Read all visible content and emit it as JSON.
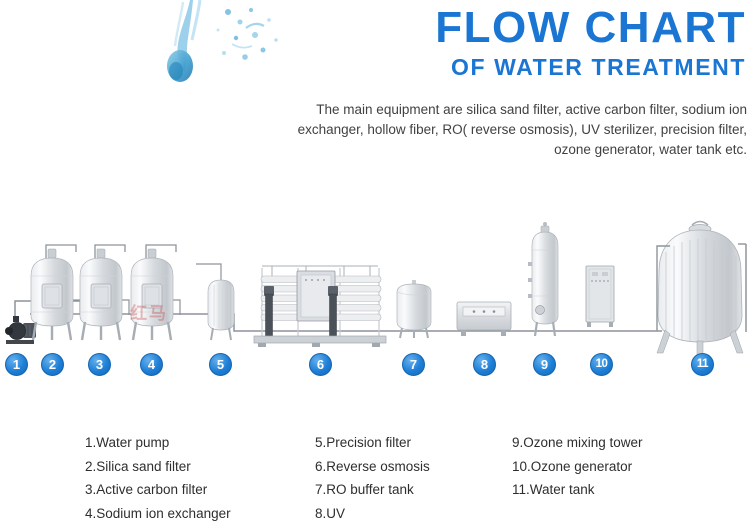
{
  "header": {
    "title": "FLOW CHART",
    "subtitle": "OF WATER TREATMENT"
  },
  "description": "The main equipment are silica sand filter, active carbon filter, sodium ion exchanger, hollow fiber, RO( reverse osmosis), UV sterilizer, precision filter, ozone generator, water tank etc.",
  "watermark": "红马",
  "colors": {
    "accent_blue": "#1a76d2",
    "badge_blue": "#1e7fd6",
    "body_text": "#414141"
  },
  "diagram": {
    "badges": [
      {
        "n": "1",
        "x": 17,
        "label": "Water pump"
      },
      {
        "n": "2",
        "x": 53,
        "label": "Silica sand filter"
      },
      {
        "n": "3",
        "x": 100,
        "label": "Active carbon filter"
      },
      {
        "n": "4",
        "x": 152,
        "label": "Sodium ion exchanger"
      },
      {
        "n": "5",
        "x": 221,
        "label": "Precision filter"
      },
      {
        "n": "6",
        "x": 321,
        "label": "Reverse osmosis"
      },
      {
        "n": "7",
        "x": 414,
        "label": "RO buffer tank"
      },
      {
        "n": "8",
        "x": 485,
        "label": "UV"
      },
      {
        "n": "9",
        "x": 545,
        "label": "Ozone mixing tower"
      },
      {
        "n": "10",
        "x": 602,
        "label": "Ozone generator"
      },
      {
        "n": "11",
        "x": 703,
        "label": "Water tank"
      }
    ]
  },
  "legend": {
    "columns": [
      [
        "1.Water pump",
        "2.Silica sand filter",
        "3.Active carbon filter",
        "4.Sodium ion exchanger"
      ],
      [
        "5.Precision filter",
        "6.Reverse osmosis",
        "7.RO buffer tank",
        "8.UV"
      ],
      [
        "9.Ozone mixing tower",
        "10.Ozone generator",
        "11.Water tank"
      ]
    ]
  }
}
